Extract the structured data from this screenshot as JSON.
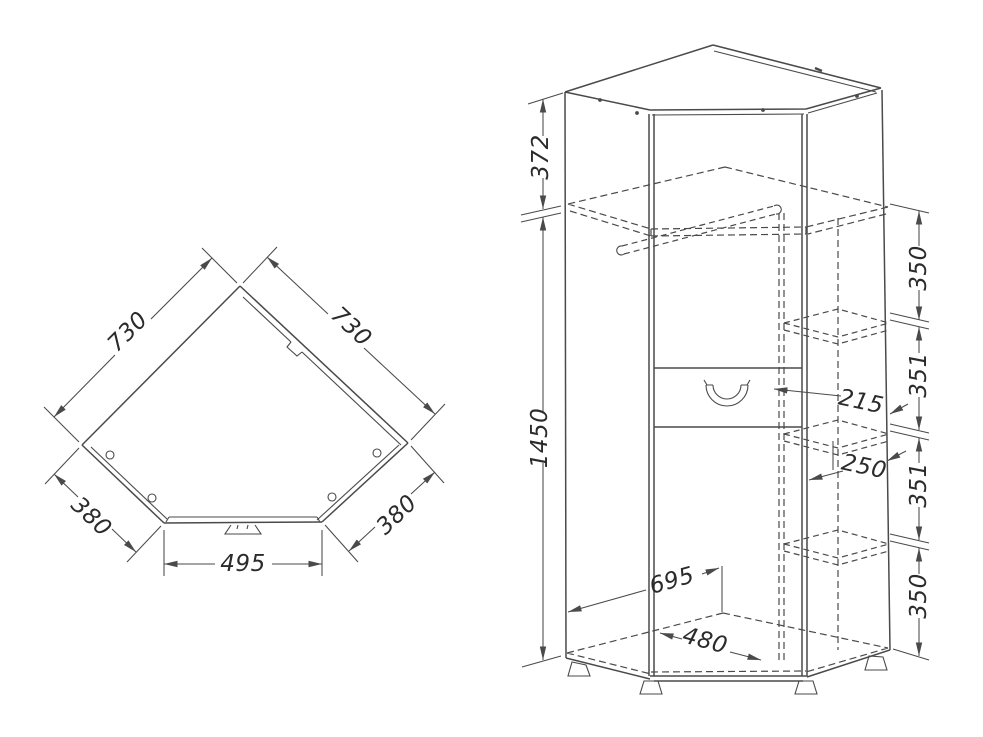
{
  "top_view": {
    "dims": {
      "side_left": "730",
      "side_right": "730",
      "return_left": "380",
      "return_right": "380",
      "front_width": "495"
    }
  },
  "front_view": {
    "dims": {
      "top_to_shelf": "372",
      "body_height": "1450",
      "chain": [
        "350",
        "351",
        "351",
        "350"
      ],
      "inner_width": "215",
      "inner_depth": "250",
      "floor_diagonal": "695",
      "floor_front_width": "480"
    }
  },
  "colors": {
    "line": "#4a4a4a",
    "text": "#2b2b2b",
    "background": "#ffffff"
  }
}
